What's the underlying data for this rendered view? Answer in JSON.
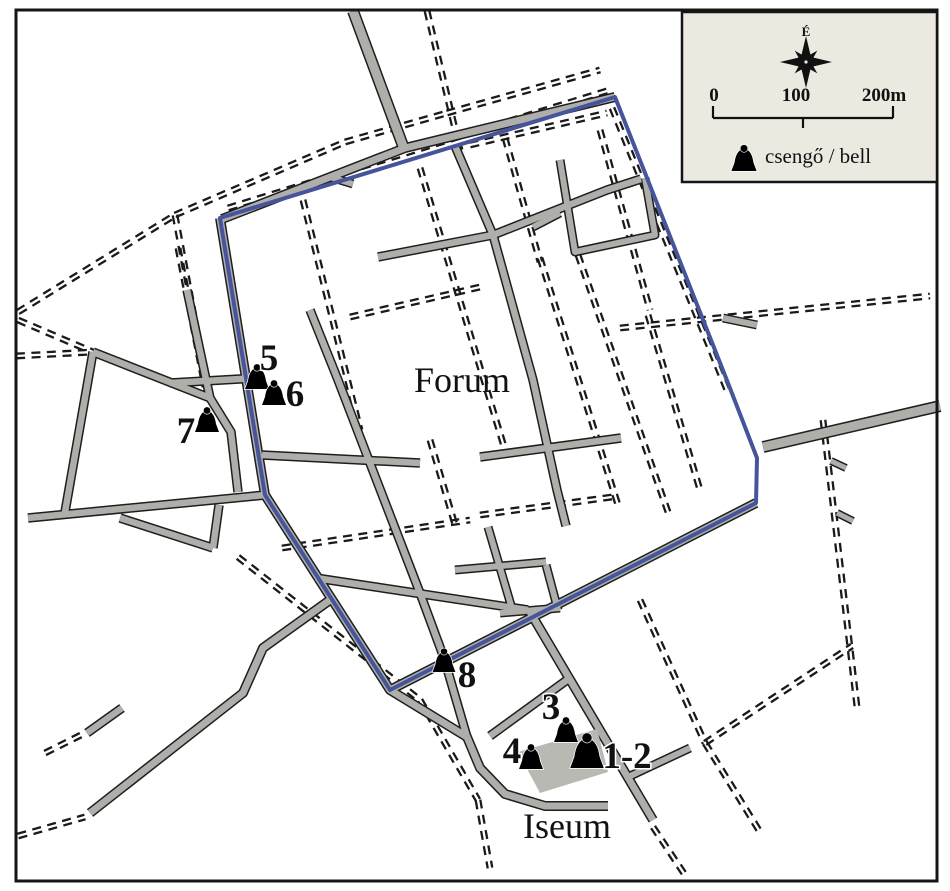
{
  "labels": {
    "forum": "Forum",
    "iseum": "Iseum"
  },
  "legend": {
    "north_label": "É",
    "scale_ticks": [
      "0",
      "100",
      "200m"
    ],
    "bell_item_label": "csengő / bell",
    "box": {
      "x": 682,
      "y": 12,
      "w": 255,
      "h": 170
    },
    "compass": {
      "cx": 806,
      "cy": 62
    },
    "scalebar": {
      "x1": 713,
      "x2": 893,
      "xm": 803,
      "y": 118
    },
    "bell_icon": {
      "x": 744,
      "y": 171,
      "s": 1.05
    }
  },
  "bells": [
    {
      "id": "1-2",
      "label": "1-2",
      "icon": {
        "x": 587,
        "y": 768,
        "s": 1.4
      },
      "label_pos": {
        "x": 627,
        "y": 768
      }
    },
    {
      "id": "3",
      "label": "3",
      "icon": {
        "x": 566,
        "y": 742,
        "s": 1.0
      },
      "label_pos": {
        "x": 551,
        "y": 719
      }
    },
    {
      "id": "4",
      "label": "4",
      "icon": {
        "x": 531,
        "y": 769,
        "s": 1.0
      },
      "label_pos": {
        "x": 512,
        "y": 763
      }
    },
    {
      "id": "5",
      "label": "5",
      "icon": {
        "x": 257,
        "y": 389,
        "s": 1.0
      },
      "label_pos": {
        "x": 269,
        "y": 370
      }
    },
    {
      "id": "6",
      "label": "6",
      "icon": {
        "x": 274,
        "y": 405,
        "s": 1.0
      },
      "label_pos": {
        "x": 295,
        "y": 406
      }
    },
    {
      "id": "7",
      "label": "7",
      "icon": {
        "x": 207,
        "y": 432,
        "s": 1.0
      },
      "label_pos": {
        "x": 186,
        "y": 443
      }
    },
    {
      "id": "8",
      "label": "8",
      "icon": {
        "x": 444,
        "y": 672,
        "s": 0.95
      },
      "label_pos": {
        "x": 467,
        "y": 687
      }
    }
  ],
  "colors": {
    "road_fill": "#aeaeaa",
    "road_edge": "#1e1e1e",
    "dashed": "#1a1a1a",
    "wall": "#46549b",
    "legend_bg": "#ece9e0",
    "building": "#b9b9b3",
    "frame": "#151515",
    "text": "#111111"
  },
  "map": {
    "frame": {
      "x": 16,
      "y": 10,
      "w": 921,
      "h": 871
    },
    "wall": [
      [
        220,
        218
      ],
      [
        615,
        97
      ],
      [
        728,
        383
      ],
      [
        757,
        458
      ],
      [
        756,
        503
      ],
      [
        390,
        690
      ],
      [
        265,
        495
      ]
    ],
    "building": [
      [
        518,
        752
      ],
      [
        597,
        729
      ],
      [
        608,
        772
      ],
      [
        540,
        793
      ]
    ],
    "gray_roads": [
      {
        "pts": [
          [
            222,
            219
          ],
          [
            405,
            148
          ],
          [
            615,
            97
          ]
        ],
        "w": 7
      },
      {
        "pts": [
          [
            220,
            218
          ],
          [
            265,
            495
          ],
          [
            390,
            690
          ],
          [
            756,
            503
          ]
        ],
        "w": 7
      },
      {
        "pts": [
          [
            353,
            11
          ],
          [
            403,
            146
          ]
        ],
        "w": 9
      },
      {
        "pts": [
          [
            187,
            290
          ],
          [
            210,
            398
          ]
        ],
        "w": 6.5
      },
      {
        "pts": [
          [
            93,
            352
          ],
          [
            210,
            398
          ]
        ],
        "w": 6.5
      },
      {
        "pts": [
          [
            93,
            352
          ],
          [
            65,
            512
          ]
        ],
        "w": 6.5
      },
      {
        "pts": [
          [
            28,
            518
          ],
          [
            265,
            495
          ]
        ],
        "w": 6.5
      },
      {
        "pts": [
          [
            120,
            518
          ],
          [
            213,
            548
          ]
        ],
        "w": 6.5
      },
      {
        "pts": [
          [
            213,
            548
          ],
          [
            219,
            505
          ]
        ],
        "w": 6.5
      },
      {
        "pts": [
          [
            210,
            398
          ],
          [
            231,
            432
          ],
          [
            238,
            492
          ]
        ],
        "w": 6.5
      },
      {
        "pts": [
          [
            170,
            383
          ],
          [
            257,
            378
          ]
        ],
        "w": 6.5
      },
      {
        "pts": [
          [
            330,
            600
          ],
          [
            263,
            648
          ],
          [
            243,
            693
          ],
          [
            90,
            813
          ]
        ],
        "w": 7
      },
      {
        "pts": [
          [
            87,
            733
          ],
          [
            122,
            708
          ]
        ],
        "w": 6.5
      },
      {
        "pts": [
          [
            763,
            447
          ],
          [
            940,
            406
          ]
        ],
        "w": 9
      },
      {
        "pts": [
          [
            723,
            318
          ],
          [
            757,
            325
          ]
        ],
        "w": 6
      },
      {
        "pts": [
          [
            831,
            461
          ],
          [
            846,
            468
          ]
        ],
        "w": 5
      },
      {
        "pts": [
          [
            837,
            513
          ],
          [
            853,
            521
          ]
        ],
        "w": 5
      },
      {
        "pts": [
          [
            530,
            612
          ],
          [
            653,
            820
          ]
        ],
        "w": 7
      },
      {
        "pts": [
          [
            390,
            690
          ],
          [
            467,
            737
          ],
          [
            480,
            768
          ],
          [
            505,
            794
          ],
          [
            545,
            806
          ],
          [
            608,
            806
          ]
        ],
        "w": 7
      },
      {
        "pts": [
          [
            567,
            680
          ],
          [
            490,
            736
          ]
        ],
        "w": 6.5
      },
      {
        "pts": [
          [
            628,
            777
          ],
          [
            690,
            748
          ]
        ],
        "w": 6
      },
      {
        "pts": [
          [
            310,
            310
          ],
          [
            338,
            380
          ],
          [
            420,
            593
          ],
          [
            444,
            658
          ],
          [
            467,
            737
          ]
        ],
        "w": 6.5
      },
      {
        "pts": [
          [
            455,
            146
          ],
          [
            493,
            235
          ],
          [
            533,
            380
          ],
          [
            557,
            490
          ],
          [
            566,
            526
          ]
        ],
        "w": 6.5
      },
      {
        "pts": [
          [
            378,
            257
          ],
          [
            493,
            235
          ],
          [
            607,
            190
          ],
          [
            641,
            179
          ]
        ],
        "w": 6.5
      },
      {
        "pts": [
          [
            330,
            177
          ],
          [
            353,
            184
          ]
        ],
        "w": 6
      },
      {
        "pts": [
          [
            560,
            160
          ],
          [
            575,
            252
          ],
          [
            655,
            235
          ],
          [
            645,
            178
          ]
        ],
        "w": 6
      },
      {
        "pts": [
          [
            533,
            227
          ],
          [
            560,
            213
          ]
        ],
        "w": 6
      },
      {
        "pts": [
          [
            480,
            457
          ],
          [
            621,
            438
          ]
        ],
        "w": 6.5
      },
      {
        "pts": [
          [
            262,
            455
          ],
          [
            420,
            463
          ]
        ],
        "w": 6.5
      },
      {
        "pts": [
          [
            316,
            578
          ],
          [
            528,
            610
          ]
        ],
        "w": 6.5
      },
      {
        "pts": [
          [
            455,
            570
          ],
          [
            546,
            562
          ]
        ],
        "w": 6
      },
      {
        "pts": [
          [
            488,
            527
          ],
          [
            513,
            612
          ]
        ],
        "w": 6
      },
      {
        "pts": [
          [
            546,
            565
          ],
          [
            558,
            610
          ]
        ],
        "w": 6
      },
      {
        "pts": [
          [
            500,
            613
          ],
          [
            560,
            608
          ]
        ],
        "w": 6
      }
    ],
    "dashed_roads": [
      {
        "pts": [
          [
            427,
            11
          ],
          [
            460,
            150
          ]
        ]
      },
      {
        "pts": [
          [
            175,
            215
          ],
          [
            345,
            142
          ],
          [
            447,
            113
          ],
          [
            600,
            70
          ]
        ]
      },
      {
        "pts": [
          [
            18,
            312
          ],
          [
            175,
            215
          ]
        ]
      },
      {
        "pts": [
          [
            175,
            215
          ],
          [
            197,
            332
          ]
        ]
      },
      {
        "pts": [
          [
            178,
            248
          ],
          [
            205,
            387
          ]
        ]
      },
      {
        "pts": [
          [
            18,
            320
          ],
          [
            93,
            352
          ]
        ]
      },
      {
        "pts": [
          [
            16,
            356
          ],
          [
            93,
            352
          ]
        ]
      },
      {
        "pts": [
          [
            228,
            208
          ],
          [
            610,
            90
          ]
        ]
      },
      {
        "pts": [
          [
            612,
            108
          ],
          [
            727,
            390
          ]
        ]
      },
      {
        "pts": [
          [
            620,
            328
          ],
          [
            930,
            296
          ]
        ]
      },
      {
        "pts": [
          [
            823,
            420
          ],
          [
            857,
            707
          ]
        ]
      },
      {
        "pts": [
          [
            705,
            743
          ],
          [
            852,
            646
          ]
        ]
      },
      {
        "pts": [
          [
            705,
            743
          ],
          [
            760,
            832
          ]
        ]
      },
      {
        "pts": [
          [
            640,
            600
          ],
          [
            705,
            743
          ]
        ]
      },
      {
        "pts": [
          [
            653,
            827
          ],
          [
            687,
            878
          ]
        ]
      },
      {
        "pts": [
          [
            238,
            557
          ],
          [
            420,
            700
          ]
        ]
      },
      {
        "pts": [
          [
            420,
            700
          ],
          [
            478,
            800
          ],
          [
            490,
            868
          ]
        ]
      },
      {
        "pts": [
          [
            18,
            836
          ],
          [
            85,
            817
          ]
        ]
      },
      {
        "pts": [
          [
            45,
            753
          ],
          [
            85,
            733
          ]
        ]
      },
      {
        "pts": [
          [
            420,
            168
          ],
          [
            505,
            450
          ]
        ]
      },
      {
        "pts": [
          [
            540,
            258
          ],
          [
            618,
            505
          ]
        ]
      },
      {
        "pts": [
          [
            578,
            255
          ],
          [
            668,
            512
          ]
        ]
      },
      {
        "pts": [
          [
            282,
            548
          ],
          [
            470,
            520
          ]
        ]
      },
      {
        "pts": [
          [
            480,
            515
          ],
          [
            612,
            497
          ]
        ]
      },
      {
        "pts": [
          [
            350,
            317
          ],
          [
            480,
            287
          ]
        ]
      },
      {
        "pts": [
          [
            505,
            138
          ],
          [
            540,
            262
          ]
        ]
      },
      {
        "pts": [
          [
            470,
            145
          ],
          [
            607,
            113
          ]
        ]
      },
      {
        "pts": [
          [
            600,
            130
          ],
          [
            650,
            310
          ]
        ]
      },
      {
        "pts": [
          [
            648,
            315
          ],
          [
            700,
            490
          ]
        ]
      },
      {
        "pts": [
          [
            303,
            200
          ],
          [
            360,
            430
          ]
        ]
      },
      {
        "pts": [
          [
            430,
            440
          ],
          [
            455,
            525
          ]
        ]
      }
    ]
  }
}
